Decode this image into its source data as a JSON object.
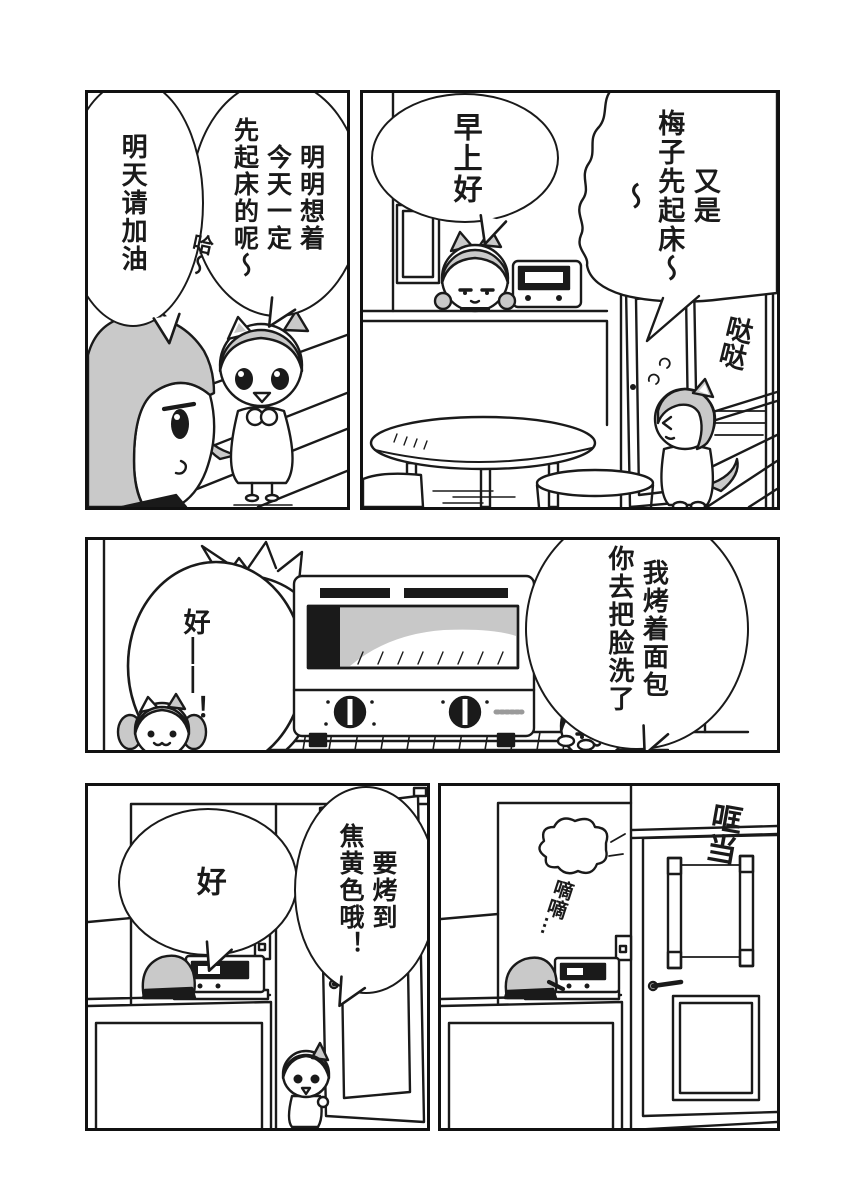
{
  "page": {
    "background": "#ffffff",
    "ink": "#1a1a1a",
    "hair_gray": "#c9c9c9"
  },
  "panels": {
    "p1": {
      "label": "top-right-kitchen-morning",
      "bubble_offpanel": "又是\n梅子先起床～～",
      "bubble_greeting": "早上好",
      "sfx_running": "哒哒"
    },
    "p2": {
      "label": "top-left-yawning-talk",
      "bubble_regret": "明明想着\n今天一定\n先起床的呢～",
      "sfx_yawn": "哈～",
      "bubble_tomorrow": "明天请加油"
    },
    "p3": {
      "label": "middle-toaster-counter",
      "bubble_reply": "好——！",
      "bubble_instruction": "我烤着面包\n你去把脸洗了"
    },
    "p4": {
      "label": "bottom-left-door-request",
      "bubble_ok": "好",
      "bubble_toast": "要烤到\n焦黄色哦！"
    },
    "p5": {
      "label": "bottom-right-door-closed",
      "sfx_door": "哐当",
      "sfx_beep": "嘀嘀…"
    }
  }
}
